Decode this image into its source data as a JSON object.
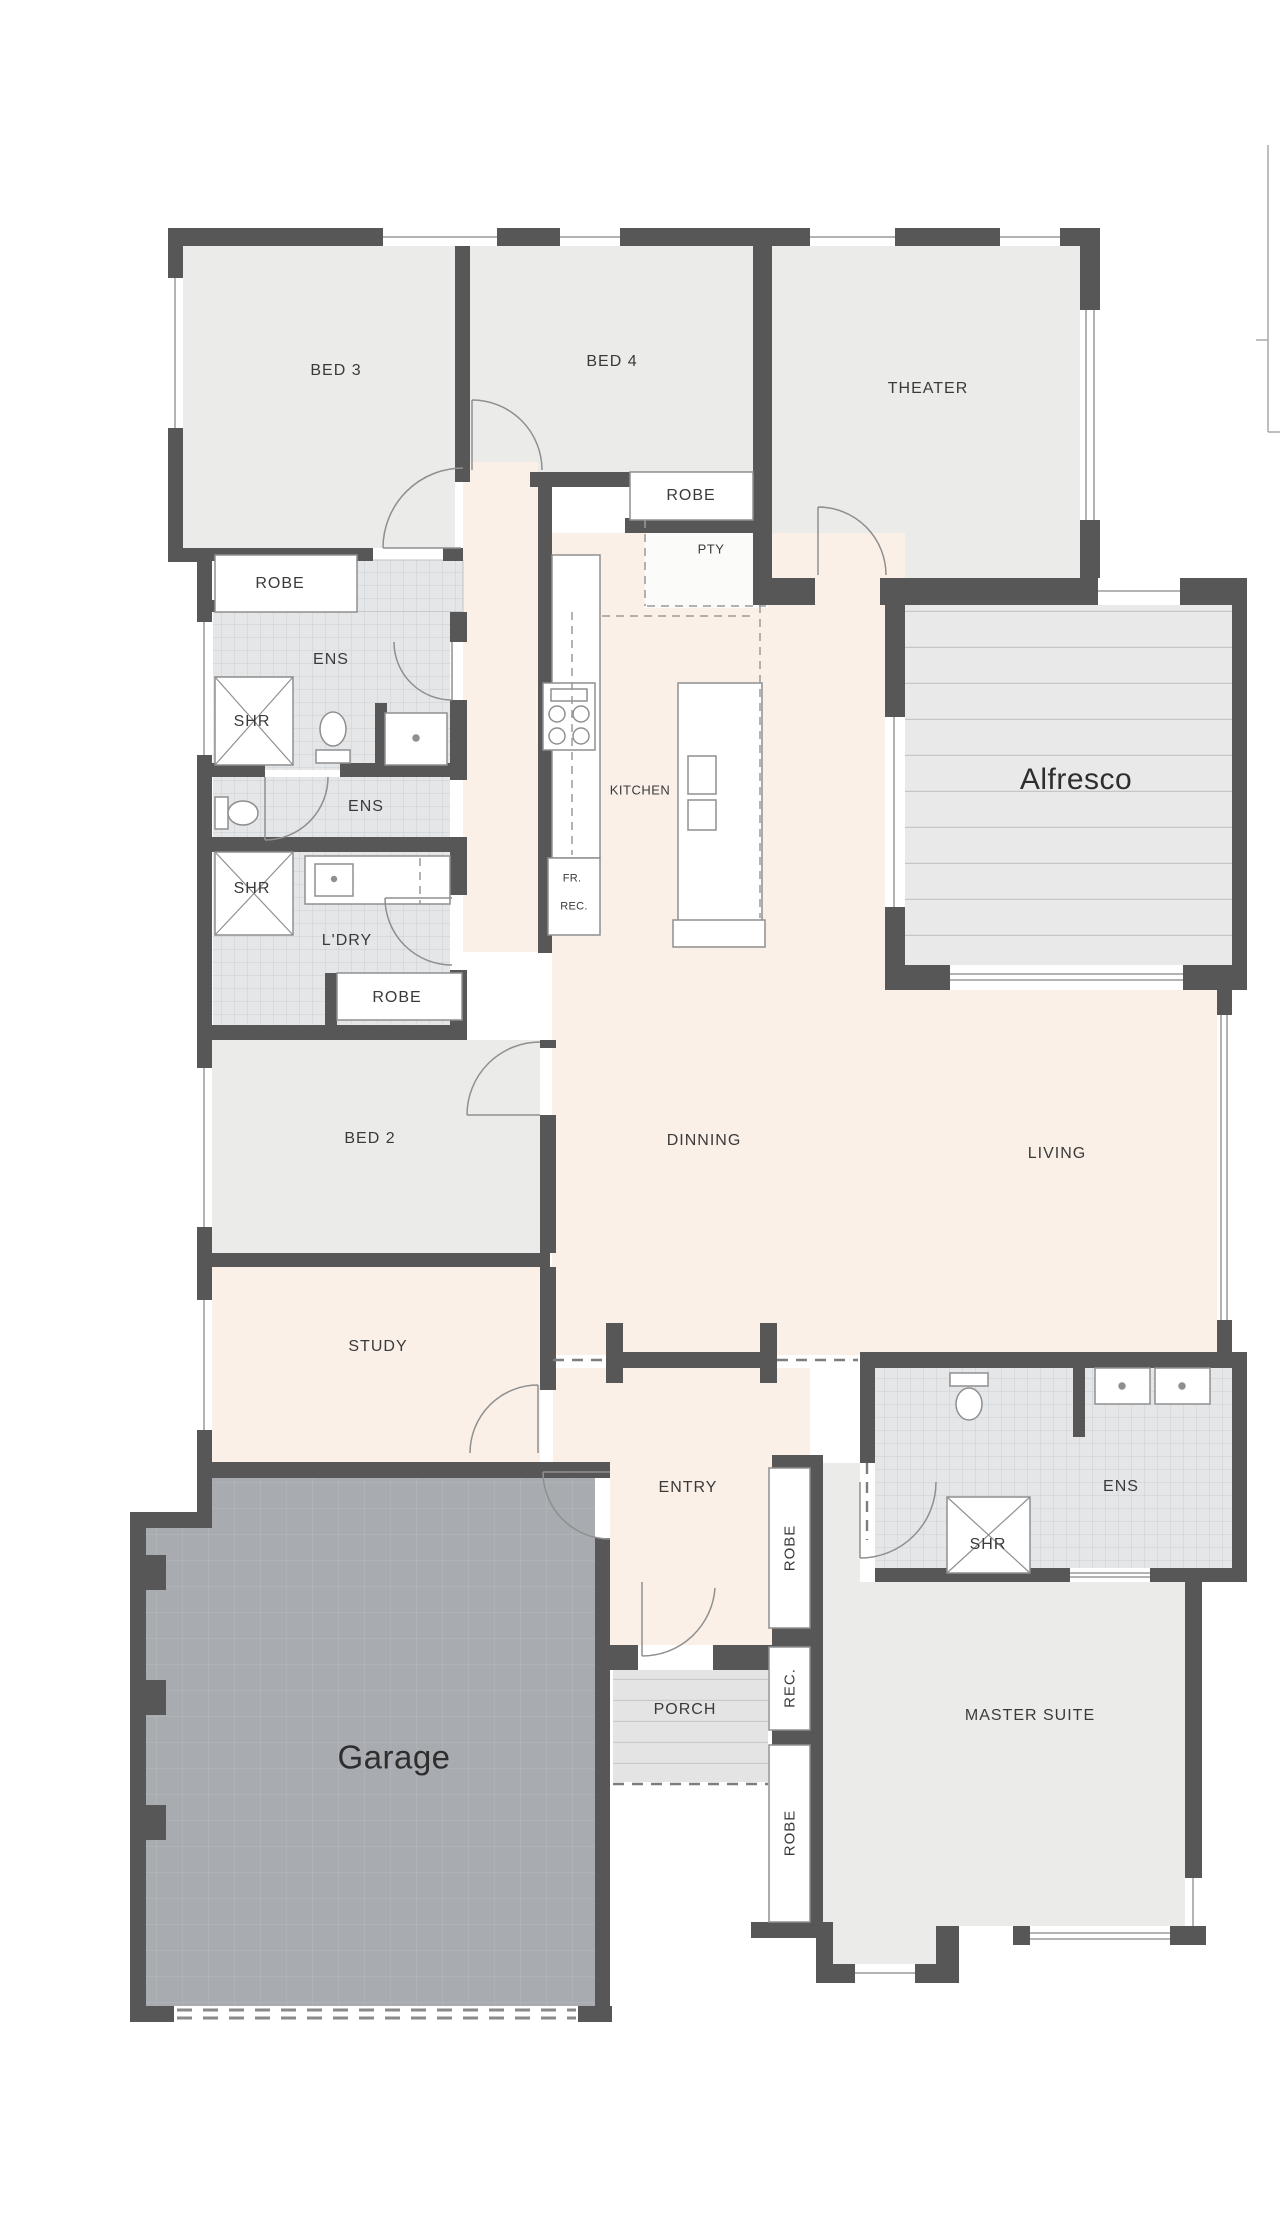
{
  "page": {
    "background": "#ffffff"
  },
  "floor_plan": {
    "colors": {
      "wall": "#575757",
      "room_fill": "#ebebe9",
      "circulation_fill": "#faf0e8",
      "tile_fill": "#e4e6e8",
      "tile_grid": "#cdd0d3",
      "deck_fill": "#e9e9e9",
      "deck_line": "#c6c6c6",
      "garage_fill": "#a8acb1",
      "garage_grid": "#b6babd",
      "porch_fill": "#e4e4e4",
      "fixture_stroke": "#8f8f8f",
      "window_line": "#9a9a9a",
      "label_text": "#3a3a3a"
    },
    "labels": [
      {
        "text": "BED 3",
        "x": 336,
        "y": 371,
        "cls": "room"
      },
      {
        "text": "BED 4",
        "x": 612,
        "y": 362,
        "cls": "room"
      },
      {
        "text": "THEATER",
        "x": 928,
        "y": 389,
        "cls": "room"
      },
      {
        "text": "ROBE",
        "x": 280,
        "y": 584,
        "cls": "room"
      },
      {
        "text": "ENS",
        "x": 331,
        "y": 660,
        "cls": "room"
      },
      {
        "text": "SHR",
        "x": 252,
        "y": 722,
        "cls": "room"
      },
      {
        "text": "ENS",
        "x": 366,
        "y": 807,
        "cls": "room"
      },
      {
        "text": "SHR",
        "x": 252,
        "y": 889,
        "cls": "room"
      },
      {
        "text": "L'DRY",
        "x": 347,
        "y": 941,
        "cls": "room"
      },
      {
        "text": "ROBE",
        "x": 397,
        "y": 998,
        "cls": "room"
      },
      {
        "text": "ROBE",
        "x": 691,
        "y": 496,
        "cls": "room"
      },
      {
        "text": "PTY",
        "x": 711,
        "y": 549,
        "cls": "small"
      },
      {
        "text": "KITCHEN",
        "x": 640,
        "y": 790,
        "cls": "small"
      },
      {
        "text": "FR.",
        "x": 572,
        "y": 879,
        "cls": "tiny"
      },
      {
        "text": "REC.",
        "x": 574,
        "y": 907,
        "cls": "tiny"
      },
      {
        "text": "Alfresco",
        "x": 1076,
        "y": 780,
        "cls": "big"
      },
      {
        "text": "BED 2",
        "x": 370,
        "y": 1139,
        "cls": "room"
      },
      {
        "text": "DINNING",
        "x": 704,
        "y": 1141,
        "cls": "room"
      },
      {
        "text": "LIVING",
        "x": 1057,
        "y": 1154,
        "cls": "room"
      },
      {
        "text": "STUDY",
        "x": 378,
        "y": 1347,
        "cls": "room"
      },
      {
        "text": "ENTRY",
        "x": 688,
        "y": 1488,
        "cls": "room"
      },
      {
        "text": "ROBE",
        "x": 790,
        "y": 1548,
        "cls": "vert"
      },
      {
        "text": "REC.",
        "x": 790,
        "y": 1688,
        "cls": "vert"
      },
      {
        "text": "ROBE",
        "x": 790,
        "y": 1833,
        "cls": "vert"
      },
      {
        "text": "SHR",
        "x": 988,
        "y": 1545,
        "cls": "room"
      },
      {
        "text": "ENS",
        "x": 1121,
        "y": 1487,
        "cls": "room"
      },
      {
        "text": "MASTER SUITE",
        "x": 1030,
        "y": 1716,
        "cls": "room"
      },
      {
        "text": "PORCH",
        "x": 685,
        "y": 1710,
        "cls": "room"
      },
      {
        "text": "Garage",
        "x": 394,
        "y": 1757,
        "cls": "garage"
      }
    ]
  }
}
